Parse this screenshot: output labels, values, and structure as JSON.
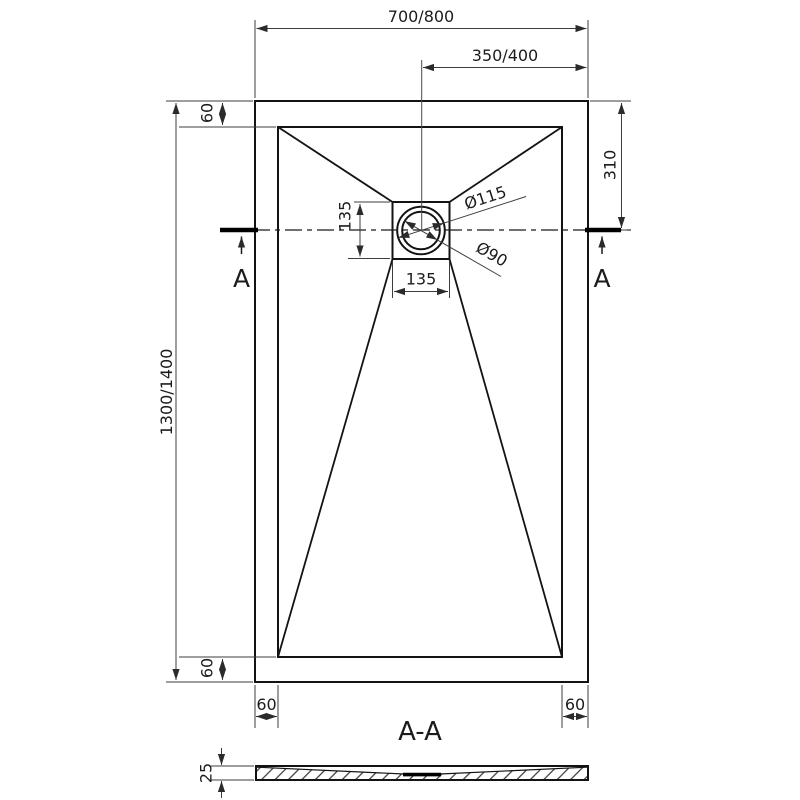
{
  "plan": {
    "width_label": "700/800",
    "half_width_label": "350/400",
    "height_label": "1300/1400",
    "drain_offset_label": "310",
    "border_top_label": "60",
    "border_bottom_label": "60",
    "border_left_label": "60",
    "border_right_label": "60",
    "drain_square_height_label": "135",
    "drain_square_width_label": "135",
    "drain_flange_dia_label": "Ø115",
    "drain_hole_dia_label": "Ø90",
    "section_marker_left": "A",
    "section_marker_right": "A"
  },
  "section": {
    "title": "A-A",
    "thickness_label": "25"
  },
  "colors": {
    "main_line": "#131313",
    "dim_line": "#3d3d3d",
    "text": "#1c1c1c",
    "background": "#ffffff"
  }
}
